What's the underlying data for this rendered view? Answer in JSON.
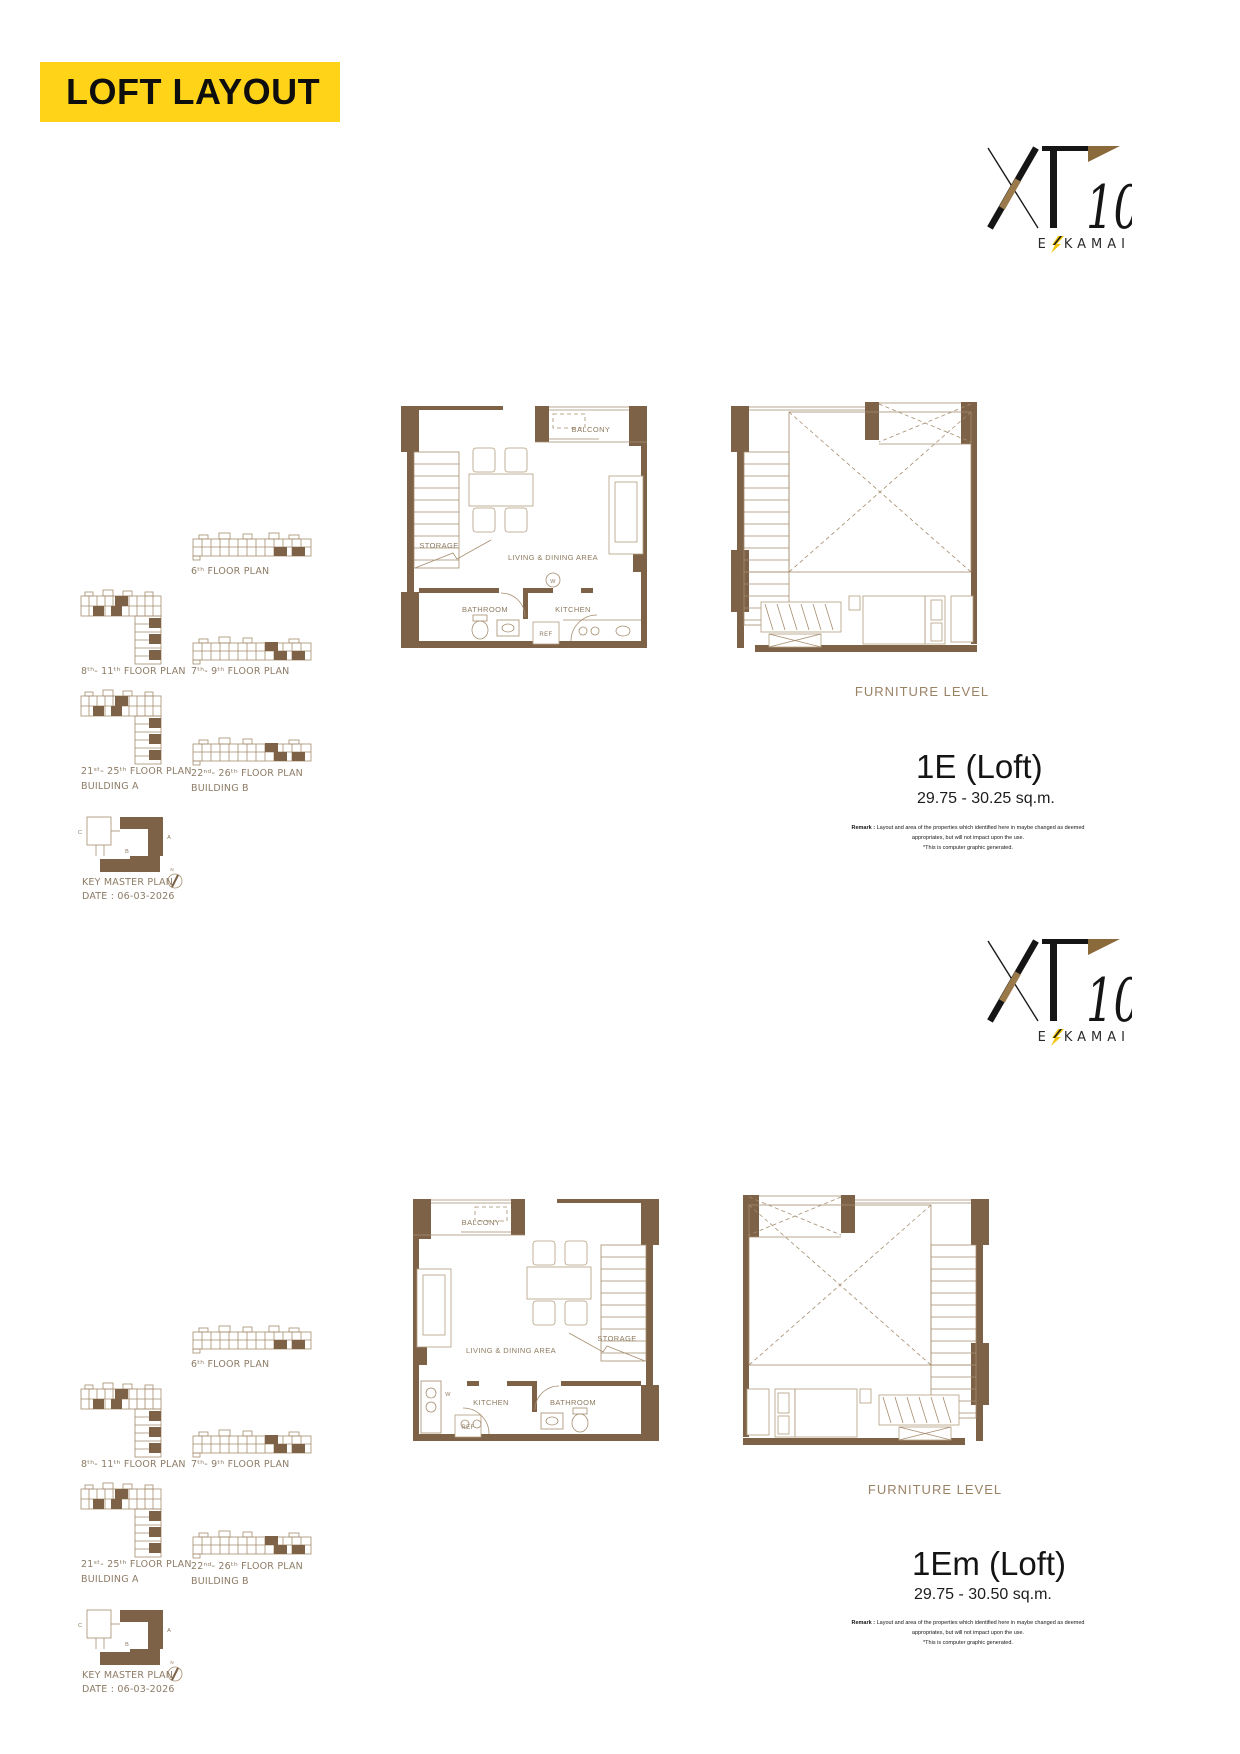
{
  "banner": {
    "label": "LOFT LAYOUT"
  },
  "logo": {
    "brand": "XT",
    "number": "10",
    "sub_prefix": "E",
    "sub_suffix": "KAMAI"
  },
  "key_plans": {
    "floor_6_label": "6ᵗʰ  FLOOR PLAN",
    "floor_8_11_label": "8ᵗʰ- 11ᵗʰ  FLOOR PLAN",
    "floor_7_9_label": "7ᵗʰ- 9ᵗʰ  FLOOR PLAN",
    "floor_21_25_label": "21ˢᵗ- 25ᵗʰ  FLOOR PLAN",
    "building_a_label": "BUILDING A",
    "floor_22_26_label": "22ⁿᵈ- 26ᵗʰ  FLOOR PLAN",
    "building_b_label": "BUILDING B",
    "key_master_plan_label": "KEY MASTER PLAN",
    "date_label": "DATE : 06-03-2026",
    "marker_a": "A",
    "marker_b": "B",
    "marker_c": "C",
    "marker_n": "N"
  },
  "plan_labels": {
    "balcony": "BALCONY",
    "storage": "STORAGE",
    "living_dining": "LIVING & DINING AREA",
    "bathroom": "BATHROOM",
    "kitchen": "KITCHEN",
    "ref": "REF",
    "washer": "W",
    "furniture_level": "FURNITURE LEVEL"
  },
  "units": [
    {
      "name": "1E (Loft)",
      "area_range": "29.75 - 30.25 sq.m."
    },
    {
      "name": "1Em (Loft)",
      "area_range": "29.75 - 30.50 sq.m."
    }
  ],
  "remark": {
    "prefix": "Remark :",
    "line1": "Layout and area of the properties which identified here in maybe changed as deemed",
    "line2": "appropriates, but will not impact upon the use.",
    "line3": "*This is computer graphic generated."
  },
  "colors": {
    "banner_yellow": "#FFD418",
    "wall_brown": "#7D6247",
    "plan_line": "#A58D6F",
    "label_brown": "#8D7B66",
    "logo_bolt_yellow": "#F2C50A"
  }
}
